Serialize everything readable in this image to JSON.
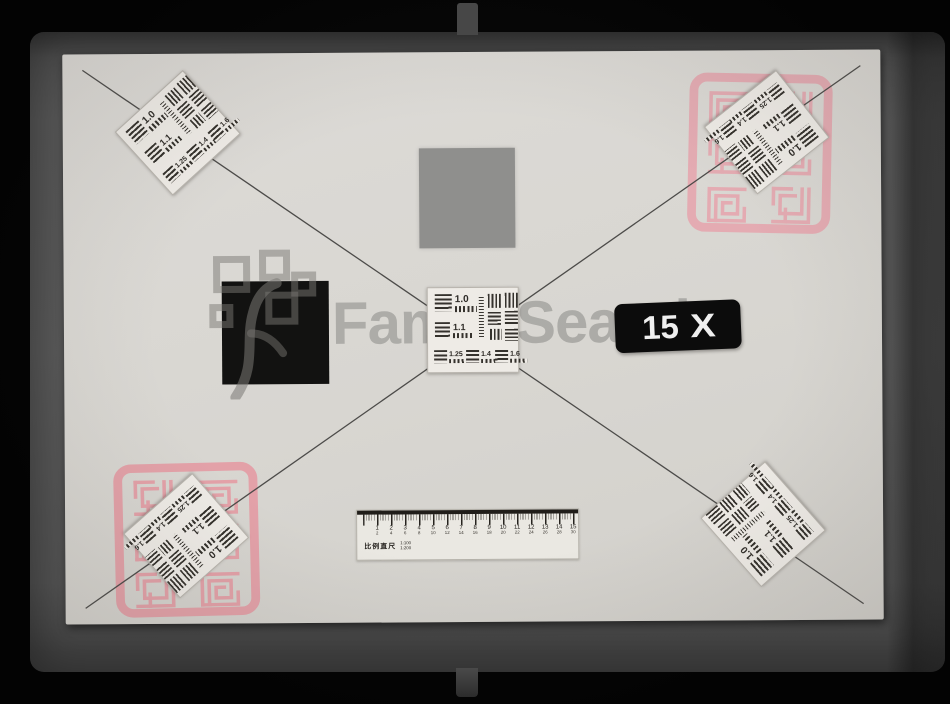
{
  "frame": {
    "type": "microfilm-calibration-frame",
    "watermark": {
      "text": "FamilySearch"
    }
  },
  "magnification_badge": {
    "value": "15",
    "symbol": "X"
  },
  "resolution_target": {
    "labels": [
      "1.0",
      "1.1",
      "1.25",
      "1.4",
      "1.6"
    ],
    "instances": [
      "top-left",
      "top-right",
      "center",
      "bottom-left",
      "bottom-right"
    ]
  },
  "seals": {
    "description": "pink chinese seal-script stamp",
    "color": "#e8a3ac",
    "instances": [
      "top-right",
      "bottom-left"
    ]
  },
  "ruler": {
    "label": "比例直尺",
    "legend": [
      "1:100",
      "1:200"
    ],
    "major_numbers": [
      1,
      2,
      3,
      4,
      5,
      6,
      7,
      8,
      9,
      10,
      11,
      12,
      13,
      14,
      15
    ],
    "sub_numbers": [
      2,
      4,
      6,
      8,
      10,
      12,
      14,
      16,
      18,
      20,
      22,
      24,
      26,
      28,
      30
    ]
  },
  "colors": {
    "background": "#040404",
    "film_frame": "#555555",
    "card": "#d8d6d1",
    "gray_patch": "#8f8f8d",
    "black_patch": "#121211",
    "badge_bg": "#0c0c0c",
    "badge_text": "#efefef",
    "seal_pink": "#e8a3ac"
  }
}
